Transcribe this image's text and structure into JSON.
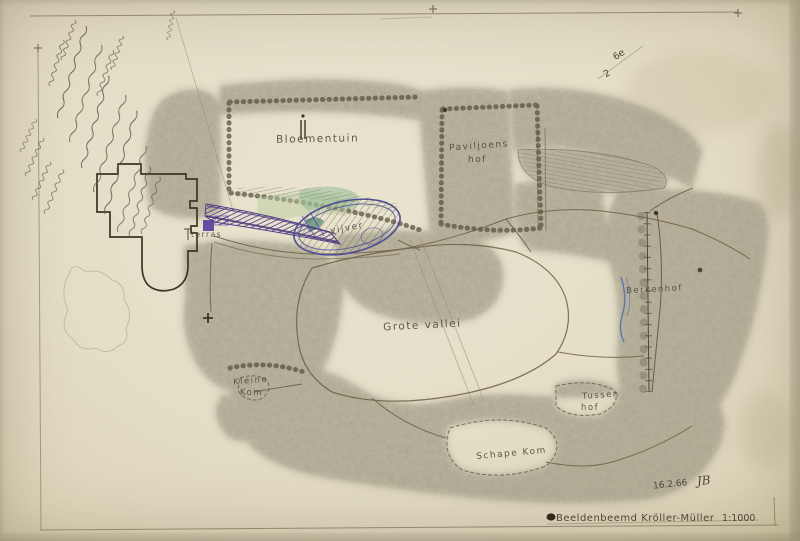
{
  "artwork": {
    "title": "Beeldenbeemd Kröller-Müller",
    "scale_note": "1:1000",
    "date": "16.2.66",
    "monogram": "JB",
    "corner_note_top": "6e",
    "corner_note_bottom": "2"
  },
  "labels": {
    "bloementuin": "Bloementuin",
    "paviljoens": "Paviljoens",
    "paviljoens_hof": "hof",
    "terras": "terras",
    "vijver": "vijver",
    "grote_vallei": "Grote vallei",
    "berkenhof": "Berkenhof",
    "kleine": "Kleine",
    "kleine_kom": "Kom",
    "tussen": "Tussen",
    "tussen_hof": "hof",
    "schape_kom": "Schape Kom"
  },
  "colors": {
    "paper": "#e8e2cc",
    "pencil_trees": "#6e6852",
    "ink": "#4a4334",
    "purple_hatch": "#4e338c",
    "pond_outline": "#4c4c96",
    "green_wash": "#b9cc9f",
    "teal_wash": "#8fb891",
    "stream_blue": "#4f6fb0"
  }
}
